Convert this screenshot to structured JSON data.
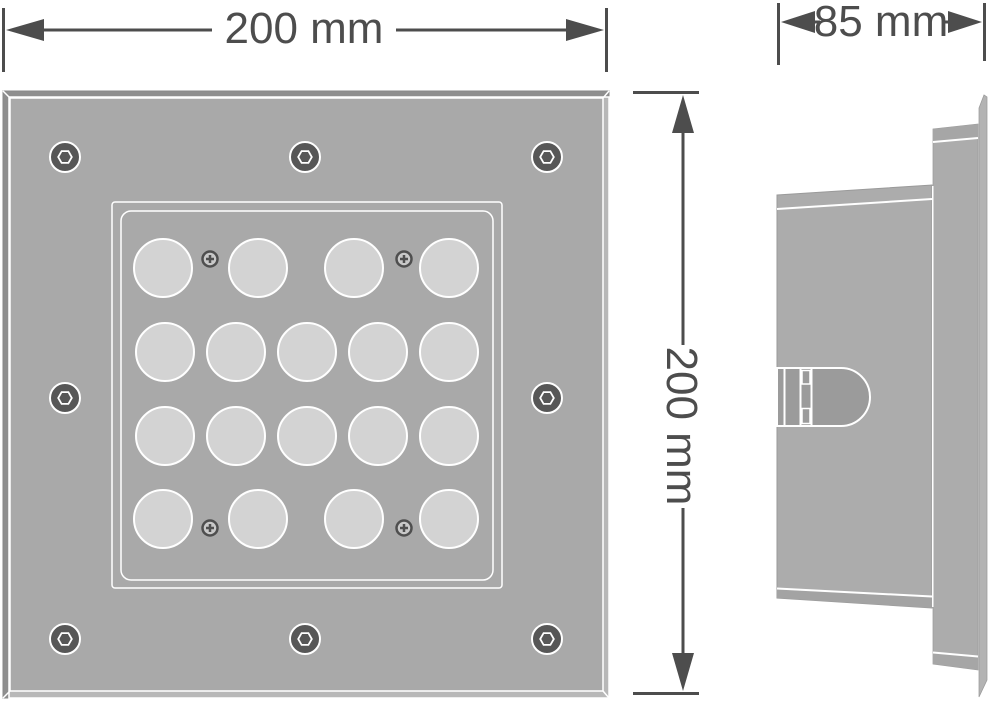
{
  "dimensions": {
    "width": {
      "value": 200,
      "unit": "mm",
      "label": "200 mm"
    },
    "height": {
      "value": 200,
      "unit": "mm",
      "label": "200 mm"
    },
    "depth": {
      "value": 85,
      "unit": "mm",
      "label": "85 mm"
    }
  },
  "front_view": {
    "led_count": 18,
    "led_radius": 29,
    "led_rows": [
      {
        "y": 268,
        "x": [
          163,
          258,
          354,
          449
        ]
      },
      {
        "y": 352,
        "x": [
          165,
          236,
          307,
          378,
          449
        ]
      },
      {
        "y": 436,
        "x": [
          165,
          236,
          307,
          378,
          449
        ]
      },
      {
        "y": 519,
        "x": [
          163,
          258,
          354,
          449
        ]
      }
    ],
    "hex_screws": [
      [
        65,
        157
      ],
      [
        305,
        157
      ],
      [
        547,
        157
      ],
      [
        65,
        398
      ],
      [
        547,
        398
      ],
      [
        65,
        639
      ],
      [
        305,
        639
      ],
      [
        547,
        639
      ]
    ],
    "cross_screws": [
      [
        210,
        259
      ],
      [
        404,
        259
      ],
      [
        210,
        528
      ],
      [
        404,
        528
      ]
    ]
  },
  "colors": {
    "background": "#ffffff",
    "dimension_line": "#4d4d4d",
    "plate_face": "#a9a9a9",
    "plate_side_dark": "#8f8f8f",
    "plate_chamfer_light": "#b8b8b8",
    "panel_outline": "#ffffff",
    "led_fill": "#d3d3d3",
    "screw_disc": "#575757",
    "housing_fill": "#acacac",
    "housing_band": "#a3a3a3",
    "latch_fill": "#9b9b9b",
    "edge_sliver": "#b3b3b3"
  }
}
